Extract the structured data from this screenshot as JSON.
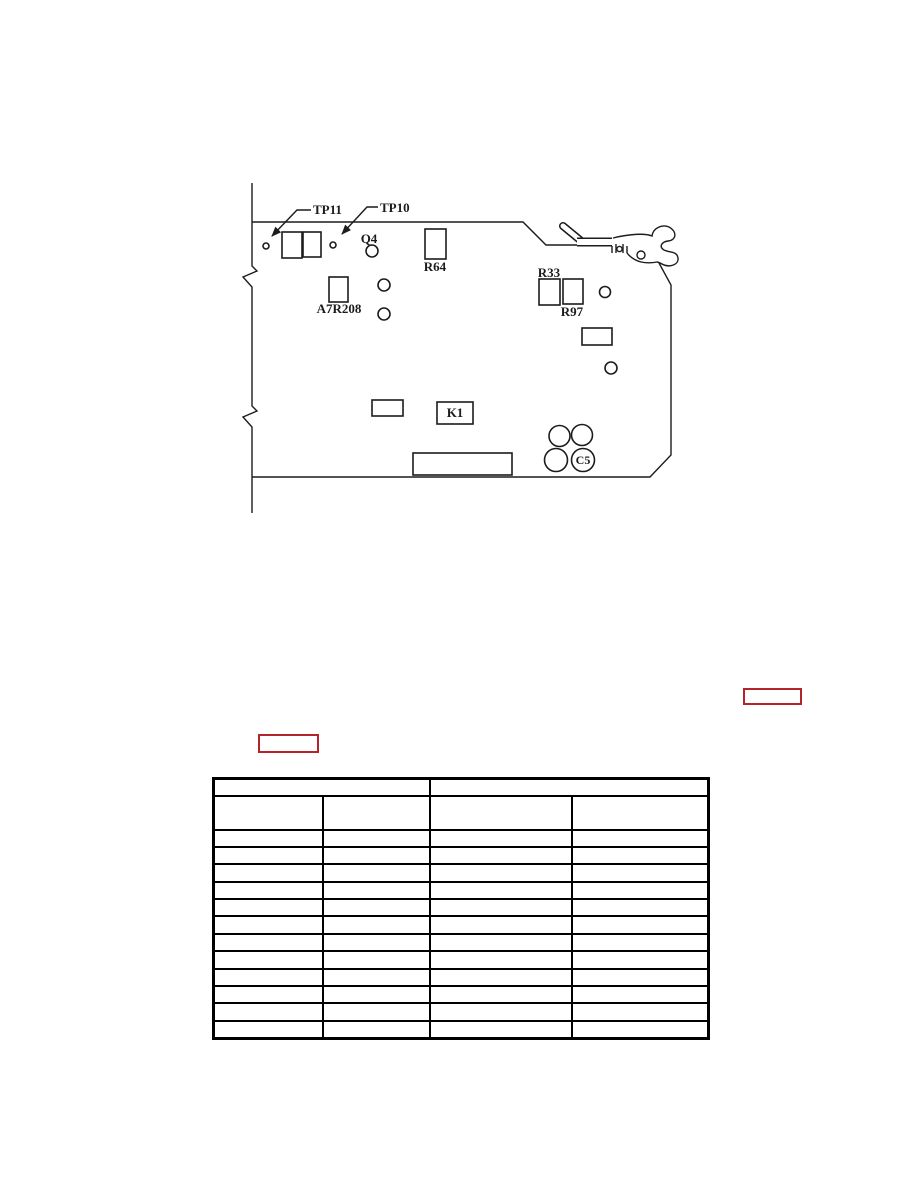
{
  "page": {
    "background_color": "#ffffff"
  },
  "figure": {
    "name": "circuit-board-component-location-diagram",
    "stroke_color": "#1c1c1c",
    "labels": {
      "tp11": "TP11",
      "tp10": "TP10",
      "q4": "Q4",
      "r64": "R64",
      "a7r208": "A7R208",
      "r33": "R33",
      "r97": "R97",
      "k1": "K1",
      "c5": "C5"
    }
  },
  "links": {
    "border_color": "#b5232b",
    "items": [
      {
        "label": ""
      },
      {
        "label": ""
      }
    ]
  },
  "table": {
    "border_color": "#000000",
    "column_count": 4,
    "data_row_count": 12,
    "header_groups": [
      {
        "label": ""
      },
      {
        "label": ""
      }
    ],
    "column_headers": [
      {
        "label": ""
      },
      {
        "label": ""
      },
      {
        "label": ""
      },
      {
        "label": ""
      }
    ]
  }
}
